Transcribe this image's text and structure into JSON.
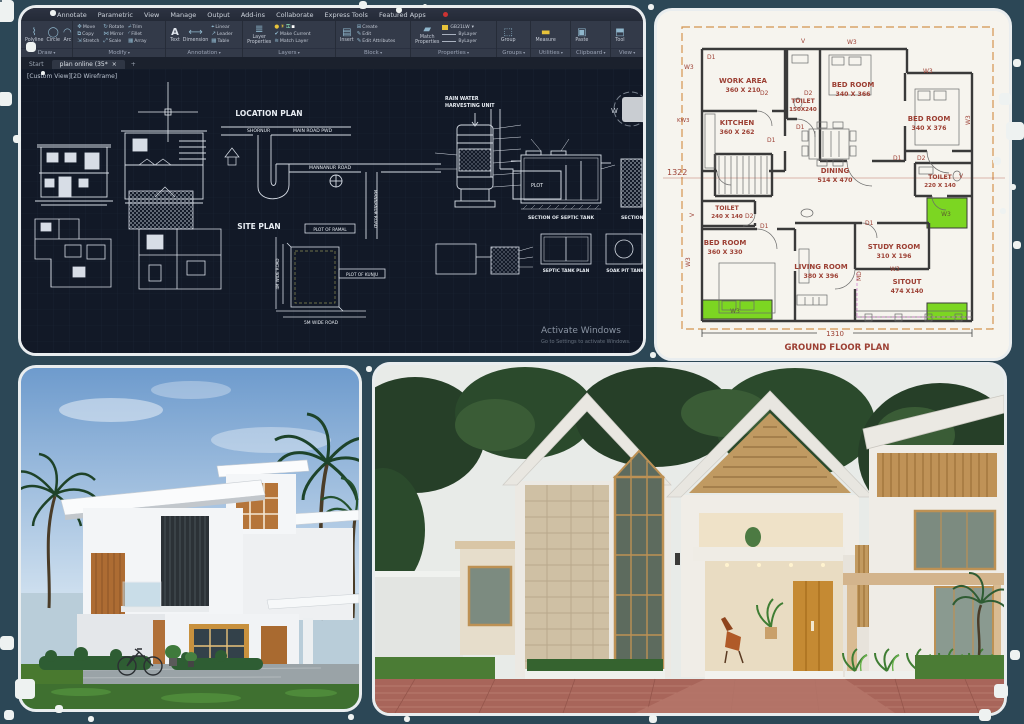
{
  "colors": {
    "page_bg": "#2c4756",
    "acad_canvas": "#121927",
    "acad_ribbon": "#333a49",
    "plan_label": "#9c3f33",
    "plan_highlight": "#7cd622",
    "plan_boundary": "#d4934f",
    "cad_line": "#d7dde6"
  },
  "autocad": {
    "menu": [
      "Annotate",
      "Parametric",
      "View",
      "Manage",
      "Output",
      "Add-ins",
      "Collaborate",
      "Express Tools",
      "Featured Apps"
    ],
    "ribbon": {
      "draw": {
        "label": "Draw",
        "tools": [
          "Polyline",
          "Circle",
          "Arc"
        ]
      },
      "modify": {
        "label": "Modify",
        "tools": [
          "Move",
          "Copy",
          "Stretch",
          "Rotate",
          "Mirror",
          "Scale",
          "Trim",
          "Fillet",
          "Array"
        ]
      },
      "annotation": {
        "label": "Annotation",
        "big": "Text",
        "tools": [
          "Dimension",
          "Linear",
          "Leader",
          "Table"
        ]
      },
      "layers": {
        "label": "Layers",
        "big1": "Layer",
        "big2": "Properties",
        "tools": [
          "Make Current",
          "Match Layer"
        ]
      },
      "block": {
        "label": "Block",
        "big": "Insert",
        "tools": [
          "Create",
          "Edit",
          "Edit Attributes"
        ]
      },
      "properties": {
        "label": "Properties",
        "big1": "Match",
        "big2": "Properties",
        "color": "GB21LW",
        "row2": "ByLayer",
        "row3": "ByLayer"
      },
      "groups": {
        "label": "Groups",
        "big": "Group"
      },
      "utilities": {
        "label": "Utilities",
        "big": "Measure"
      },
      "clipboard": {
        "label": "Clipboard",
        "big": "Paste"
      },
      "view": {
        "label": "View",
        "big": "Tool"
      }
    },
    "tabs": {
      "start": "Start",
      "drawing": "plan online (35*",
      "close": "×",
      "add": "+"
    },
    "viewport_label": "[Custom View][2D Wireframe]",
    "viewcube_w": "W",
    "canvas": {
      "location_plan": "LOCATION PLAN",
      "site_plan": "SITE PLAN",
      "rain_line1": "RAIN WATER",
      "rain_line2": "HARVESTING UNIT",
      "section_septic": "SECTION OF SEPTIC TANK",
      "section_partial": "SECTION OF S",
      "septic_plan": "SEPTIC TANK PLAN",
      "soak_pit": "SOAK PIT TANK",
      "road_shornur": "SHORNUR",
      "road_main": "MAIN ROAD PWD",
      "road_mannanur": "MANNANUR ROAD",
      "road_mannanur_v": "MANNANUR ROAD",
      "plot": "PLOT",
      "plot_ramal": "PLOT OF RAMAL",
      "plot_kunju": "PLOT OF KUNJU",
      "wide_road": "5M WIDE ROAD",
      "side_road": "4M WIDE ROAD",
      "watermark1": "Activate Windows",
      "watermark2": "Go to Settings to activate Windows."
    }
  },
  "floorplan": {
    "title": "GROUND FLOOR PLAN",
    "dim_bottom": "1310",
    "dim_left": "1322",
    "rooms": [
      {
        "name": "WORK AREA",
        "size": "360 X 210"
      },
      {
        "name": "TOILET",
        "size": "150X240"
      },
      {
        "name": "BED ROOM",
        "size": "340 X 366"
      },
      {
        "name": "BED ROOM",
        "size": "340 X 376"
      },
      {
        "name": "KITCHEN",
        "size": "360 X 262"
      },
      {
        "name": "DINING",
        "size": "514 X 470"
      },
      {
        "name": "TOILET",
        "size": "240 X 140"
      },
      {
        "name": "BED ROOM",
        "size": "360 X 330"
      },
      {
        "name": "LIVING ROOM",
        "size": "380 X 396"
      },
      {
        "name": "STUDY ROOM",
        "size": "310 X 196"
      },
      {
        "name": "SITOUT",
        "size": "474 X140"
      },
      {
        "name": "TOILET",
        "size": "220 X 140"
      }
    ],
    "tags": {
      "d1": "D1",
      "d2": "D2",
      "w3": "W3",
      "kw3": "KW3",
      "v": "V",
      "md": "MD"
    }
  }
}
